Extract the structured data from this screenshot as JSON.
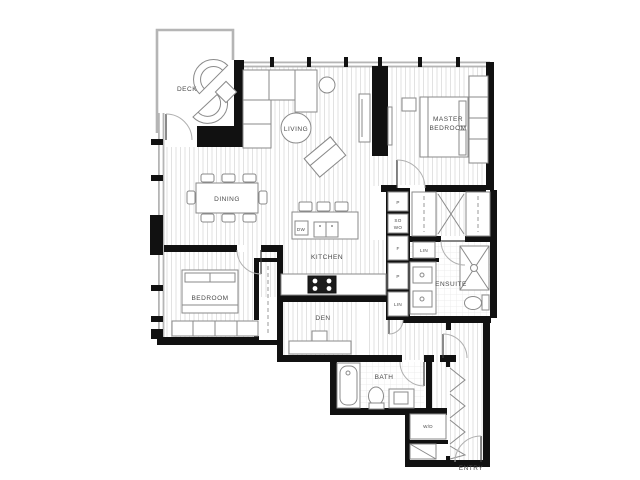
{
  "rooms": {
    "deck": "DECK",
    "living": "LIVING",
    "master1": "MASTER",
    "master2": "BEDROOM",
    "dining": "DINING",
    "kitchen": "KITCHEN",
    "bedroom": "BEDROOM",
    "den": "DEN",
    "ensuite": "ENSUITE",
    "bath": "BATH",
    "entry": "ENTRY"
  },
  "fixtures": {
    "dishwasher": "DW",
    "pantry_upper": "P",
    "oven_line1": "SO",
    "oven_line2": "WO",
    "fridge": "F",
    "pantry_lower": "P",
    "linen_cabinet": "LIN",
    "linen_hall": "LIN",
    "washer_dryer": "W/D"
  },
  "colors": {
    "wall": "#111111",
    "window_wall": "#b5b5b5",
    "furniture_stroke": "#8a8a8a",
    "floor_hatch": "#e2e2e2",
    "tile": "#ececec",
    "label": "#4a4a4a",
    "background": "#ffffff"
  }
}
